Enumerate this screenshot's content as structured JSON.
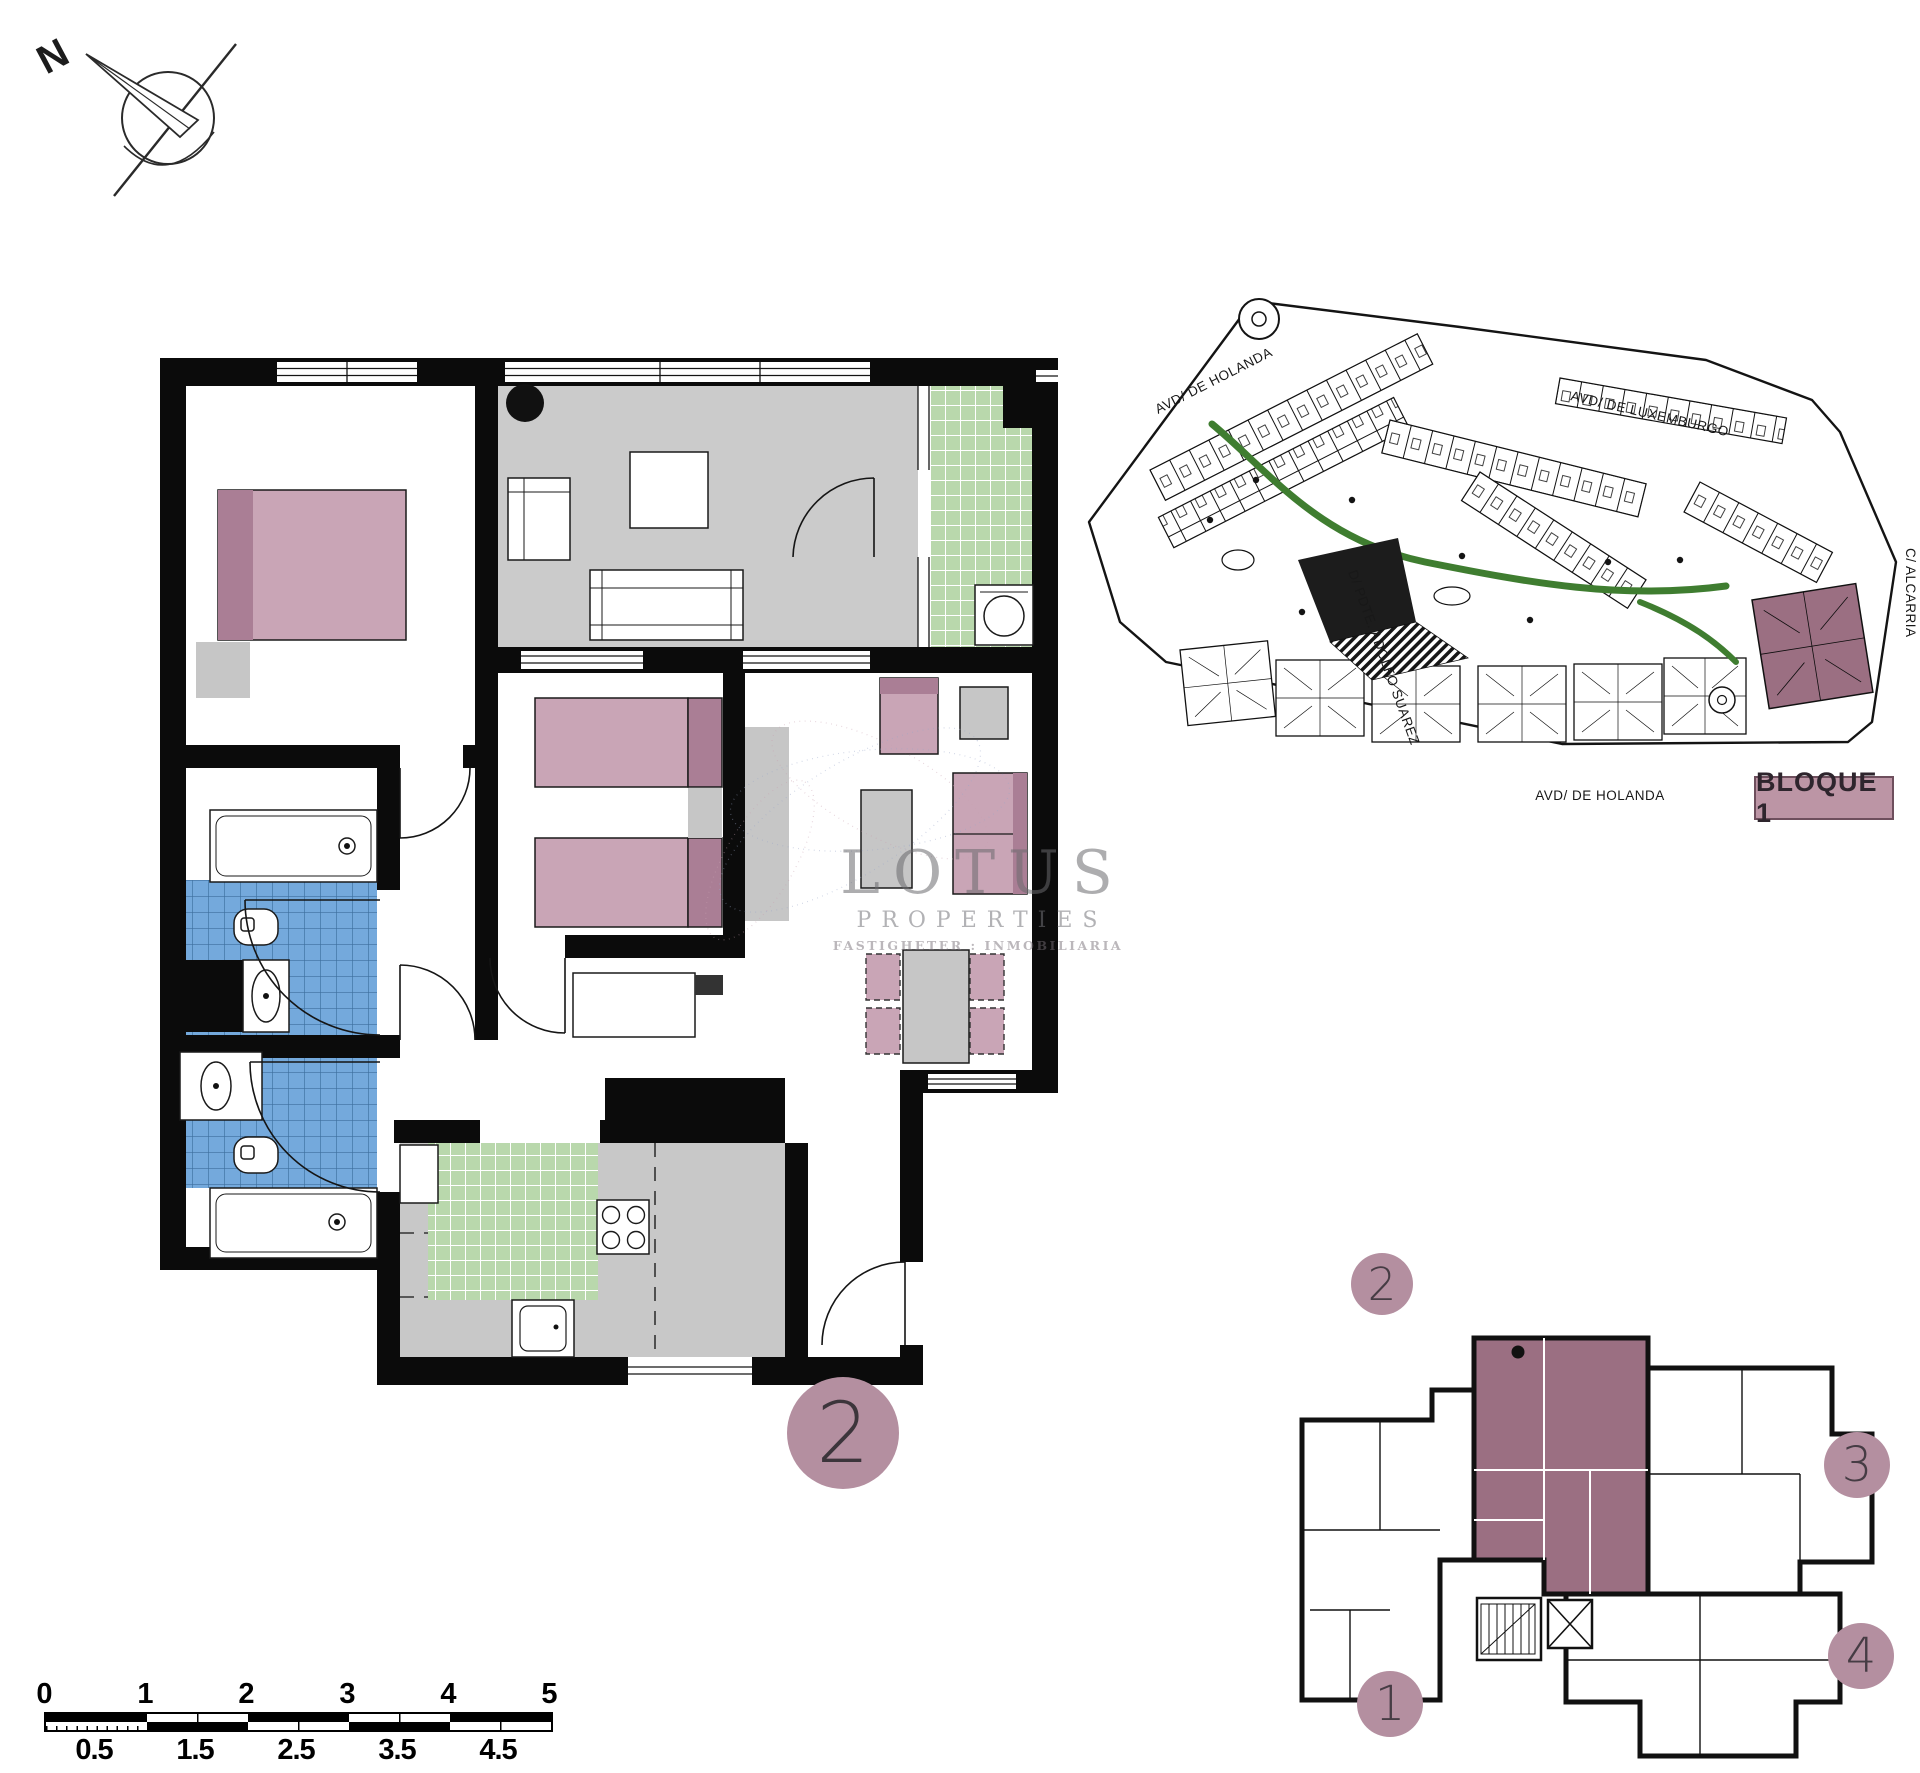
{
  "compass": {
    "north_label": "N"
  },
  "floor_plan": {
    "unit_number": "2"
  },
  "site_plan": {
    "streets": {
      "top_left": "AVD/ DE HOLANDA",
      "top_right": "AVD/ DE LUXEMBURGO",
      "right": "C/ ALCARRIA",
      "left": "D/ PDTE. ADOLFO SUAREZ",
      "bottom": "AVD/ DE HOLANDA"
    },
    "block_label": "BLOQUE 1"
  },
  "watermark": {
    "brand": "LOTUS",
    "line2": "PROPERTIES",
    "line3": "FASTIGHETER : INMOBILIARIA"
  },
  "key_plan": {
    "highlighted_unit": "2",
    "units": [
      {
        "number": "1"
      },
      {
        "number": "2"
      },
      {
        "number": "3"
      },
      {
        "number": "4"
      }
    ]
  },
  "scale_bar": {
    "major_ticks": [
      "0",
      "1",
      "2",
      "3",
      "4",
      "5"
    ],
    "minor_ticks": [
      "0.5",
      "1.5",
      "2.5",
      "3.5",
      "4.5"
    ]
  },
  "colors": {
    "wall": "#0b0b0b",
    "floor_gray": "#cbcbcb",
    "bath_tile_blue": "#74a9dc",
    "terrace_tile_green": "#b9d8ac",
    "furniture_pink": "#c9a5b6",
    "furniture_pink_dark": "#aa7e95",
    "unit_highlight": "#9b6f82",
    "label_circle": "#b48fa0",
    "landscape_green": "#3f7d30"
  }
}
